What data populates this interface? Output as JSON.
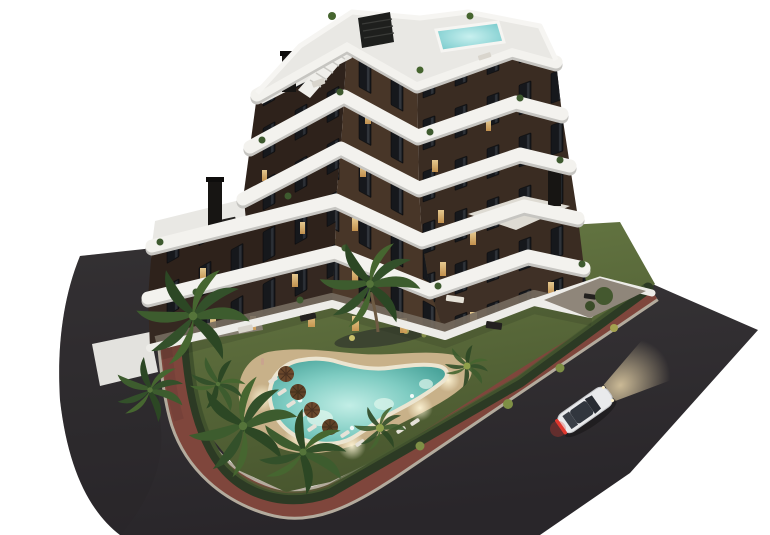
{
  "scene": {
    "type": "architectural-render-aerial-dusk",
    "objects": [
      "v-shaped-apartment-building-7-floors",
      "white-wavy-balcony-bands",
      "dark-brown-facade-with-lit-windows",
      "rooftop-terrace-with-jacuzzi",
      "rooftop-pergola-panel",
      "rooftop-stairs",
      "chimneys",
      "wing-roof-terraces-with-furniture",
      "ground-floor-terraces-white-walls",
      "garden-lawn",
      "planting-island-with-tall-palm",
      "organic-swimming-pool-lit",
      "sand-pool-deck",
      "parasols",
      "sun-loungers",
      "palm-trees",
      "perimeter-hedge",
      "brick-sidewalk-ring",
      "asphalt-roads",
      "driveway",
      "white-car-with-headlights-on"
    ],
    "counts": {
      "parasols": 4,
      "large_palms": 8,
      "cars": 1,
      "visible_floor_bands": 6
    }
  },
  "colors": {
    "background": "#ffffff",
    "asphalt": "#312e31",
    "asphaltDark": "#282528",
    "curb": "#b3ab9d",
    "sidewalk": "#7f463c",
    "driveway": "#9a9183",
    "lawn": "#5d6f41",
    "hedge": "#2c3a24",
    "island": "#3c4430",
    "deckSand": "#c8b189",
    "poolRim": "#ece5d1",
    "waterEdge": "#55b0a6",
    "waterCenter": "#c2eee6",
    "facadeLeft": "#2e221b",
    "facadeFront": "#483628",
    "facadeRight": "#3a2c22",
    "bandWhite": "#f3f2ee",
    "bandShadow": "#c6c5c1",
    "roofDeck": "#e9e8e4",
    "wallWhite": "#edece8",
    "paved": "#766c5f",
    "jacuzzi": "#93dcdc",
    "windowLit": "#e3b26b",
    "palmDark": "#33502a",
    "palmLight": "#5c7d36",
    "palmYellow": "#8fa04b",
    "trunk": "#6e5b43",
    "umbrella": "#6b482c",
    "lounger": "#e6e2d8",
    "carBody": "#e9eaec",
    "carGlass": "#282c33",
    "taillight": "#e0392f",
    "furnitureDark": "#23211f",
    "furnitureLight": "#d9d5cd",
    "chimney": "#171513"
  }
}
